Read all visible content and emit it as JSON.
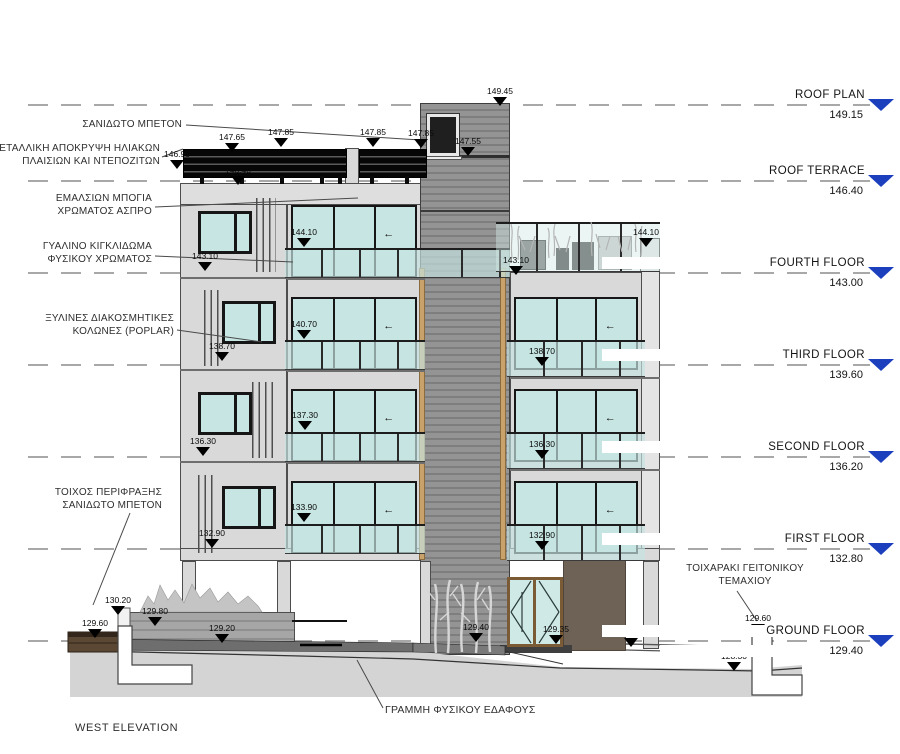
{
  "drawing": {
    "title": "WEST ELEVATION",
    "ground_line_label": "ΓΡΑΜΜΗ ΦΥΣΙΚΟΥ ΕΔΑΦΟΥΣ",
    "floor_levels": [
      {
        "name": "ROOF PLAN",
        "elevation": "149.15",
        "y": 104
      },
      {
        "name": "ROOF TERRACE",
        "elevation": "146.40",
        "y": 180
      },
      {
        "name": "FOURTH FLOOR",
        "elevation": "143.00",
        "y": 272
      },
      {
        "name": "THIRD FLOOR",
        "elevation": "139.60",
        "y": 364
      },
      {
        "name": "SECOND FLOOR",
        "elevation": "136.20",
        "y": 456
      },
      {
        "name": "FIRST FLOOR",
        "elevation": "132.80",
        "y": 548
      },
      {
        "name": "GROUND FLOOR",
        "elevation": "129.40",
        "y": 640
      }
    ],
    "material_labels": [
      {
        "id": "sanidoto-beton",
        "lines": [
          "ΣΑΝΙΔΩΤΟ ΜΠΕΤΟΝ"
        ],
        "x": 182,
        "y": 119,
        "align": "right"
      },
      {
        "id": "metalliki-apokrypsi",
        "lines": [
          "ΜΕΤΑΛΛΙΚΗ ΑΠΟΚΡΥΨΗ  ΗΛΙΑΚΩΝ",
          "ΠΛΑΙΣΙΩΝ ΚΑΙ ΝΤΕΠΟΖΙΤΩΝ"
        ],
        "x": 160,
        "y": 143,
        "align": "right"
      },
      {
        "id": "emalsion-mpogia",
        "lines": [
          "ΕΜΑΛΣΙΩΝ ΜΠΟΓΙΑ",
          "ΧΡΩΜΑΤΟΣ ΑΣΠΡΟ"
        ],
        "x": 152,
        "y": 193,
        "align": "right"
      },
      {
        "id": "gyalino-kigklidoma",
        "lines": [
          "ΓΥΑΛΙΝΟ ΚΙΓΚΛΙΔΩΜΑ",
          "ΦΥΣΙΚΟΥ ΧΡΩΜΑΤΟΣ"
        ],
        "x": 152,
        "y": 241,
        "align": "right"
      },
      {
        "id": "xylines-kolones",
        "lines": [
          "ΞΥΛΙΝΕΣ ΔΙΑΚΟΣΜΗΤΙΚΕΣ",
          "ΚΟΛΩΝΕΣ (POPLAR)"
        ],
        "x": 174,
        "y": 313,
        "align": "right"
      },
      {
        "id": "toixos-perifraksis",
        "lines": [
          "ΤΟΙΧΟΣ ΠΕΡΙΦΡΑΞΗΣ",
          "ΣΑΝΙΔΩΤΟ ΜΠΕΤΟΝ"
        ],
        "x": 162,
        "y": 487,
        "align": "right"
      },
      {
        "id": "toixaraki-geitonikou",
        "lines": [
          "ΤΟΙΧΑΡΑΚΙ ΓΕΙΤΟΝΙΚΟΥ",
          "ΤΕΜΑΧΙΟΥ"
        ],
        "x": 745,
        "y": 563,
        "align": "center"
      }
    ],
    "spot_elevations": [
      {
        "v": "149.45",
        "x": 500,
        "y": 86
      },
      {
        "v": "147.65",
        "x": 232,
        "y": 132
      },
      {
        "v": "147.85",
        "x": 281,
        "y": 127
      },
      {
        "v": "147.85",
        "x": 373,
        "y": 127
      },
      {
        "v": "147.85",
        "x": 421,
        "y": 128
      },
      {
        "v": "147.55",
        "x": 468,
        "y": 136
      },
      {
        "v": "146.90",
        "x": 177,
        "y": 149
      },
      {
        "v": "146.40",
        "x": 238,
        "y": 165
      },
      {
        "v": "144.10",
        "x": 304,
        "y": 227
      },
      {
        "v": "144.10",
        "x": 646,
        "y": 227
      },
      {
        "v": "143.10",
        "x": 205,
        "y": 251
      },
      {
        "v": "143.10",
        "x": 516,
        "y": 255
      },
      {
        "v": "140.70",
        "x": 304,
        "y": 319
      },
      {
        "v": "138.70",
        "x": 222,
        "y": 341
      },
      {
        "v": "138.70",
        "x": 542,
        "y": 346
      },
      {
        "v": "137.30",
        "x": 305,
        "y": 410
      },
      {
        "v": "136.30",
        "x": 203,
        "y": 436
      },
      {
        "v": "136.30",
        "x": 542,
        "y": 439
      },
      {
        "v": "133.90",
        "x": 304,
        "y": 502
      },
      {
        "v": "132.90",
        "x": 212,
        "y": 528
      },
      {
        "v": "132.90",
        "x": 542,
        "y": 530
      },
      {
        "v": "130.20",
        "x": 118,
        "y": 595
      },
      {
        "v": "129.80",
        "x": 155,
        "y": 606
      },
      {
        "v": "129.60",
        "x": 95,
        "y": 618
      },
      {
        "v": "129.20",
        "x": 222,
        "y": 623
      },
      {
        "v": "129.40",
        "x": 476,
        "y": 622
      },
      {
        "v": "129.35",
        "x": 556,
        "y": 624
      },
      {
        "v": "129.20",
        "x": 631,
        "y": 627
      },
      {
        "v": "129.60",
        "x": 758,
        "y": 613
      },
      {
        "v": "128.30",
        "x": 734,
        "y": 651
      }
    ],
    "colors": {
      "wall": "#d9d9d9",
      "tower": "#8f8f8f",
      "glass": "#c7e5e2",
      "frame": "#161616",
      "screen_black": "#0a0a0a",
      "level_arrow_blue": "#1c3fbe",
      "ground": "#d4d4d4",
      "pavement": "#6e6e6e",
      "brown_wall": "#6e6257",
      "retaining_wall_brown": "#5a4734",
      "door_frame_brown": "#7b5a36",
      "poplar_wood": "#c9a26b"
    }
  }
}
